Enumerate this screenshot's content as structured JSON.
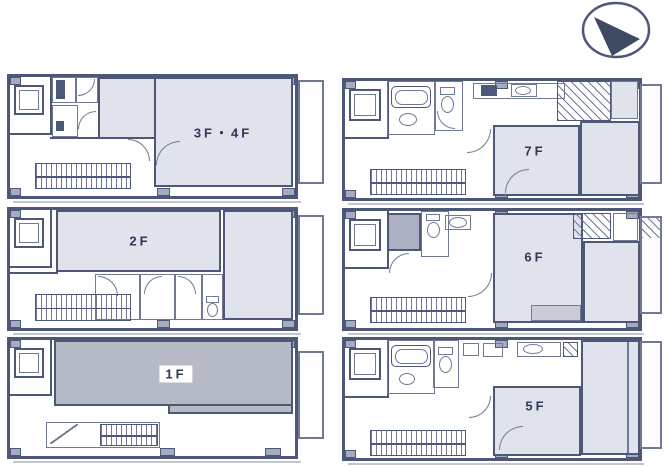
{
  "sheet": {
    "type": "building-floor-plans",
    "units": 6
  },
  "compass": {
    "name": "north-arrow"
  },
  "floors": [
    {
      "id": "3f4f",
      "label": "3F・4F"
    },
    {
      "id": "2f",
      "label": "2F"
    },
    {
      "id": "1f",
      "label": "1F"
    },
    {
      "id": "7f",
      "label": "7F"
    },
    {
      "id": "6f",
      "label": "6F"
    },
    {
      "id": "5f",
      "label": "5F"
    }
  ],
  "colors": {
    "wall": "#4d5777",
    "wall-thin": "#707996",
    "fill": "#e1e3ec",
    "fill-dark": "#b6bac6",
    "fill-step": "#c9ccd8",
    "pillar": "#a6acc0",
    "shower": "#aab0c2",
    "ink": "#2e3857",
    "paper": "#ffffff"
  }
}
